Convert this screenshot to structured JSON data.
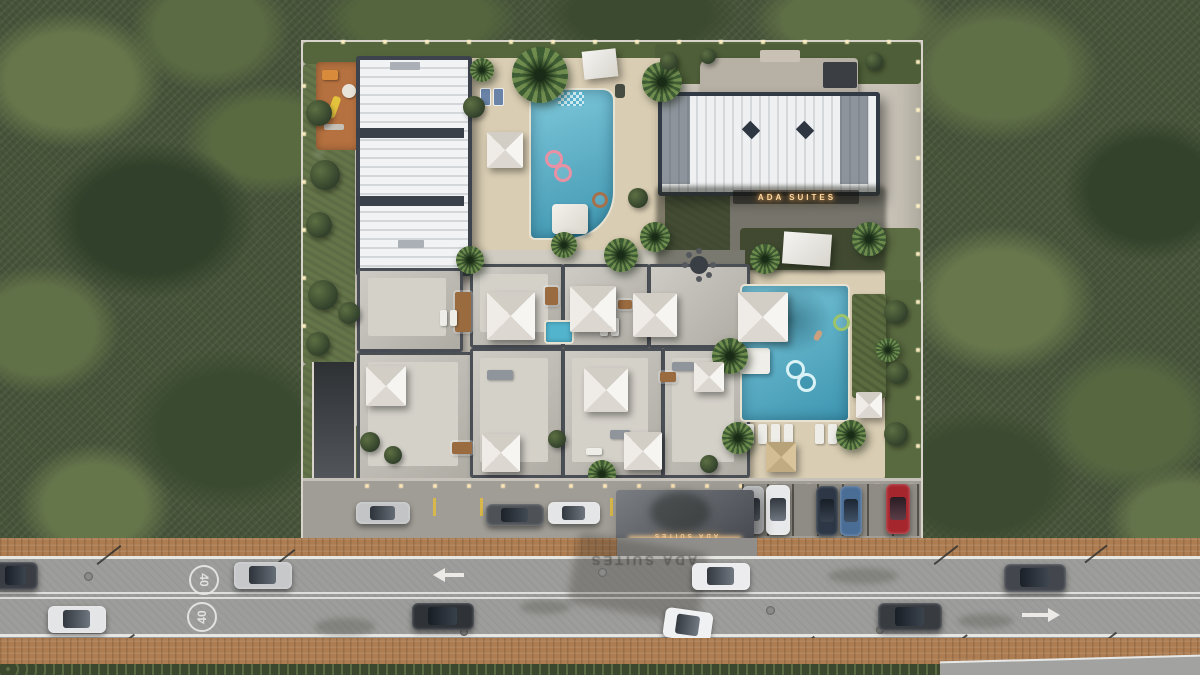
{
  "scene": {
    "title": "Aerial site render — gated suites residence in forest with front road"
  },
  "signage": {
    "building_sign": "ADA SUITES",
    "entrance_sign": "ADA SUITES",
    "road_shadow_text": "ADA SUITES"
  },
  "road": {
    "speed_limit": "40",
    "upper_lane_direction": "left",
    "lower_lane_direction": "right"
  },
  "vehicles": {
    "road_upper": [
      {
        "color": "#3a3e44"
      },
      {
        "color": "#c6c8ca"
      },
      {
        "color": "#ececee"
      },
      {
        "color": "#43474d"
      }
    ],
    "road_lower": [
      {
        "color": "#e4e5e7"
      },
      {
        "color": "#2f3338"
      },
      {
        "color": "#f0f1f2"
      },
      {
        "color": "#383c41"
      }
    ],
    "parked_parallel": [
      {
        "color": "#c2c4c6"
      },
      {
        "color": "#4e5256"
      },
      {
        "color": "#e4e5e6"
      }
    ],
    "parked_perpendicular": [
      {
        "color": "#b4b6b8"
      },
      {
        "color": "#e8e9ea"
      },
      {
        "color": "#2d3745"
      },
      {
        "color": "#4a6d96"
      },
      {
        "color": "#a6262d"
      }
    ]
  },
  "palette": {
    "forest": "#47543a",
    "site_concrete": "#c9c3b8",
    "deck": "#d9cdb3",
    "pool": "#53b4cd",
    "roof_light": "#e9ebed",
    "roof_dark": "#3d434d",
    "asphalt": "#9d9d9b",
    "paver": "#ad7c50",
    "playground": "#b5713f",
    "sign_glow": "#ffd9a2",
    "lane_marking": "#e6e6e3"
  }
}
